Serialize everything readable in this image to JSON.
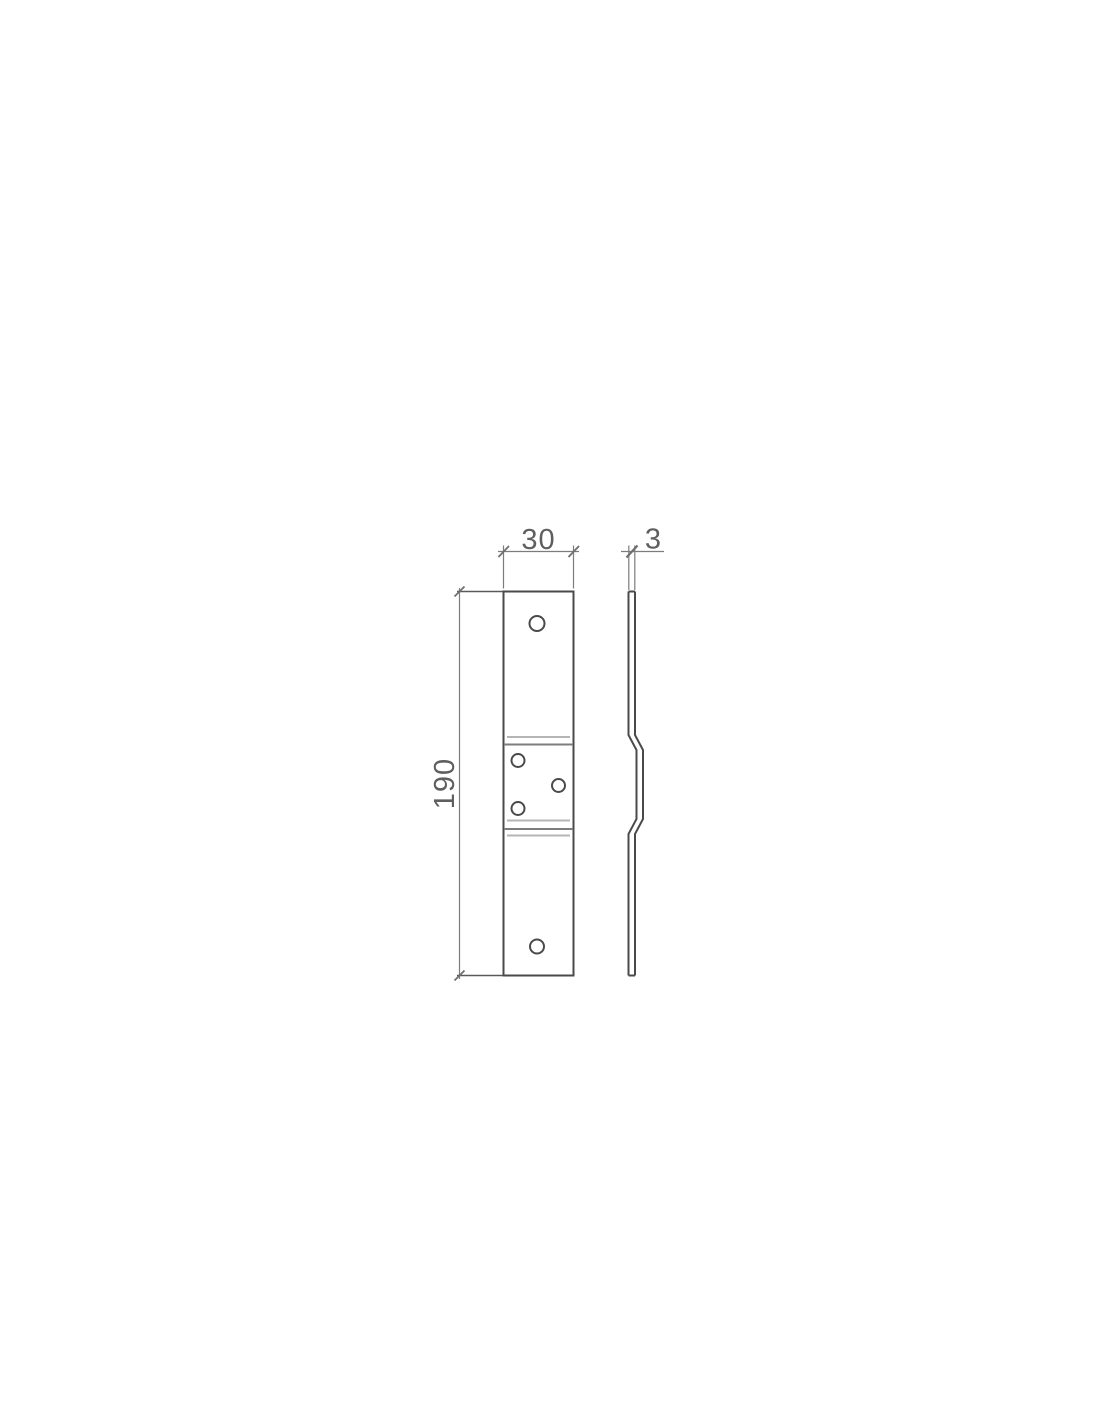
{
  "page": {
    "background": "#ffffff"
  },
  "drawing": {
    "kind": "technical-dimension-drawing",
    "dimensions": {
      "width": {
        "label": "30"
      },
      "thickness": {
        "label": "3"
      },
      "height": {
        "label": "190"
      }
    },
    "colors": {
      "outline": "#4a4a4a",
      "dimension": "#7c7c7c",
      "text": "#5f5f5f",
      "bend_light": "#b5b5b5",
      "bend_dark": "#7d7d7d"
    }
  }
}
